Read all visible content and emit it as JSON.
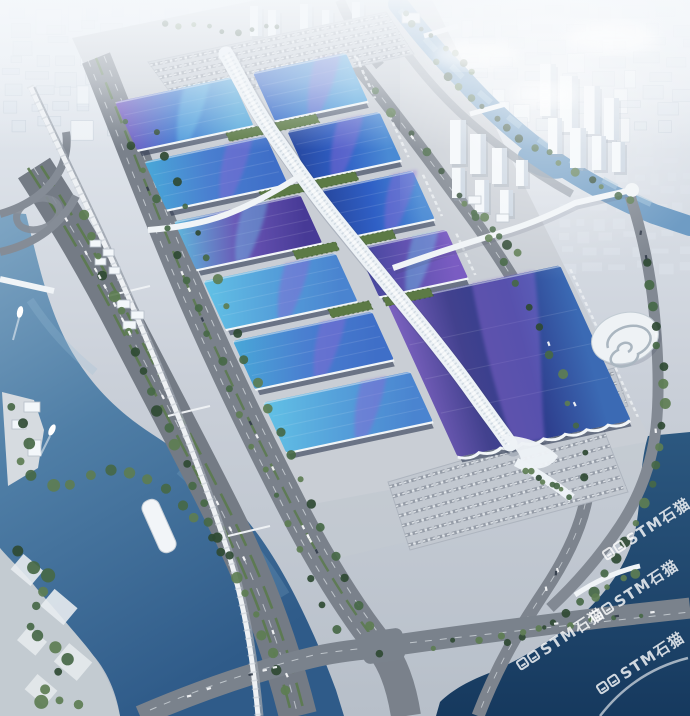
{
  "watermark": {
    "text": "STM石猫",
    "logo": "pixel-cat-squares-icon",
    "color": "#ffffff",
    "opacity": 0.8,
    "rotation_deg": -33,
    "instances": [
      {
        "x": 604,
        "y": 546
      },
      {
        "x": 592,
        "y": 608
      },
      {
        "x": 518,
        "y": 656
      },
      {
        "x": 598,
        "y": 680
      }
    ]
  },
  "palette": {
    "base_top": "#e9eef4",
    "base_mid": "#c9cfd8",
    "base_bottom": "#b7bfc9",
    "haze": "#f5f8fb",
    "city_block": "#dde4ec",
    "city_shadow": "#c2ccd8",
    "building_white": "#f3f7fa",
    "building_side": "#c9d4e0",
    "road": "#767d87",
    "road_light": "#8d949e",
    "lane": "#dde2e7",
    "median_green": "#5f7c4e",
    "tree_dark": "#2f4a33",
    "tree_mid": "#466847",
    "tree_light": "#5d7d52",
    "apron": "#c9ced5",
    "plaza_white": "#e8ecef",
    "water_ne": "#6f9cc4",
    "water_ne_light": "#a8c8de",
    "water_sw_top": "#7fa6c4",
    "water_sw_deep": "#2f5b89",
    "water_se_top": "#2c5880",
    "water_se_deep": "#16395e",
    "spine_white": "#edf2f6",
    "spine_dots": "#b9c6d2",
    "facade_dark": "#2c3750",
    "eave_white": "#f2f6f8",
    "green_roof": "#5c7a45",
    "roof_gradients": {
      "gA": [
        "#7a5cc2",
        "#3f7ad0",
        "#58aadc"
      ],
      "gB": [
        "#2f5fc5",
        "#3f84d2",
        "#55a6de"
      ],
      "gB2": [
        "#27479e",
        "#2f5fc5",
        "#4a8ad4"
      ],
      "gC": [
        "#49a8d8",
        "#4a7fd0",
        "#3f6fc8"
      ],
      "gC2": [
        "#62c2e6",
        "#55a0da",
        "#4a84d0"
      ],
      "gD": [
        "#5fb8dc",
        "#6a55b5",
        "#473a96"
      ],
      "gE": [
        "#43459c",
        "#6152b0",
        "#7a5cc2"
      ],
      "gG": [
        "#7c62c0",
        "#42418e",
        "#2e3f8e",
        "#3b6ab4"
      ]
    },
    "swoosh_purple": "#8a68d4",
    "swoosh_cyan": "#6fd0ee"
  },
  "scene": {
    "halls": [
      {
        "x0": 0,
        "x1": 119,
        "y": 0,
        "h": 52,
        "g": "gA",
        "sw": "c",
        "f": 0.46
      },
      {
        "x0": 141,
        "x1": 236,
        "y": 0,
        "h": 52,
        "g": "gB",
        "sw": "p",
        "f": 0.5
      },
      {
        "x0": 2,
        "x1": 126,
        "y": 64,
        "h": 52,
        "g": "gC",
        "sw": "p",
        "f": 0.55
      },
      {
        "x0": 148,
        "x1": 242,
        "y": 64,
        "h": 52,
        "g": "gB2",
        "sw": "p",
        "f": 0.38
      },
      {
        "x0": 4,
        "x1": 133,
        "y": 128,
        "h": 52,
        "g": "gD",
        "sw": "c",
        "f": 0.42
      },
      {
        "x0": 155,
        "x1": 248,
        "y": 128,
        "h": 52,
        "g": "gB2",
        "sw": "p",
        "f": 0.6
      },
      {
        "x0": 6,
        "x1": 141,
        "y": 192,
        "h": 52,
        "g": "gC2",
        "sw": "p",
        "f": 0.5
      },
      {
        "x0": 163,
        "x1": 254,
        "y": 192,
        "h": 52,
        "g": "gE",
        "sw": "c",
        "f": 0.45
      },
      {
        "x0": 8,
        "x1": 150,
        "y": 256,
        "h": 52,
        "g": "gC",
        "sw": "p",
        "f": 0.52
      },
      {
        "x0": 168,
        "x1": 345,
        "y": 250,
        "h": 165,
        "g": "gG",
        "sw": "p",
        "f": 0.4,
        "w": 64,
        "wavy": true
      },
      {
        "x0": 10,
        "x1": 160,
        "y": 322,
        "h": 54,
        "g": "gC2",
        "sw": "p",
        "f": 0.56
      }
    ],
    "green_roofs": [
      {
        "x": 90,
        "y": 53,
        "w": 40
      },
      {
        "x": 140,
        "y": 53,
        "w": 42
      },
      {
        "x": 96,
        "y": 117,
        "w": 42
      },
      {
        "x": 150,
        "y": 117,
        "w": 44
      },
      {
        "x": 102,
        "y": 181,
        "w": 44
      },
      {
        "x": 158,
        "y": 181,
        "w": 46
      },
      {
        "x": 110,
        "y": 245,
        "w": 42
      },
      {
        "x": 166,
        "y": 245,
        "w": 48
      }
    ],
    "towers": [
      [
        540,
        64,
        16,
        52
      ],
      [
        560,
        76,
        18,
        56
      ],
      [
        584,
        86,
        16,
        48
      ],
      [
        604,
        98,
        15,
        42
      ],
      [
        548,
        118,
        14,
        36
      ],
      [
        570,
        128,
        16,
        40
      ],
      [
        592,
        136,
        14,
        34
      ],
      [
        612,
        142,
        13,
        30
      ],
      [
        450,
        120,
        16,
        44
      ],
      [
        470,
        134,
        16,
        40
      ],
      [
        492,
        148,
        15,
        36
      ],
      [
        452,
        168,
        13,
        30
      ],
      [
        475,
        180,
        14,
        32
      ],
      [
        500,
        190,
        13,
        26
      ],
      [
        516,
        160,
        12,
        26
      ],
      [
        250,
        6,
        12,
        30
      ],
      [
        268,
        10,
        12,
        26
      ],
      [
        300,
        4,
        12,
        34
      ],
      [
        322,
        10,
        11,
        26
      ],
      [
        352,
        2,
        12,
        30
      ]
    ],
    "small_buildings": [
      [
        90,
        240,
        11,
        7
      ],
      [
        103,
        249,
        11,
        7
      ],
      [
        95,
        258,
        11,
        7
      ],
      [
        109,
        267,
        11,
        7
      ],
      [
        117,
        300,
        13,
        8
      ],
      [
        131,
        311,
        13,
        8
      ],
      [
        123,
        321,
        13,
        8
      ],
      [
        24,
        402,
        16,
        10
      ],
      [
        12,
        420,
        14,
        9
      ],
      [
        28,
        440,
        13,
        16
      ],
      [
        468,
        196,
        13,
        8
      ],
      [
        496,
        214,
        13,
        8
      ],
      [
        370,
        24,
        22,
        12
      ],
      [
        402,
        13,
        18,
        10
      ]
    ],
    "parking_lots": [
      {
        "poly": [
          [
            148,
            62
          ],
          [
            386,
            12
          ],
          [
            414,
            54
          ],
          [
            180,
            106
          ]
        ],
        "rows": 7
      },
      {
        "poly": [
          [
            388,
            482
          ],
          [
            600,
            420
          ],
          [
            628,
            492
          ],
          [
            410,
            550
          ]
        ],
        "rows": 7
      },
      {
        "poly": [
          [
            528,
            392
          ],
          [
            614,
            368
          ],
          [
            628,
            406
          ],
          [
            540,
            432
          ]
        ],
        "rows": 4
      }
    ],
    "tree_lines": [
      {
        "pts": [
          [
            84,
            205
          ],
          [
            105,
            275
          ],
          [
            150,
            390
          ],
          [
            205,
            510
          ],
          [
            255,
            615
          ],
          [
            290,
            700
          ]
        ],
        "n": 26,
        "r": 4.5
      },
      {
        "pts": [
          [
            152,
            118
          ],
          [
            205,
            255
          ],
          [
            262,
            395
          ],
          [
            330,
            545
          ],
          [
            385,
            665
          ]
        ],
        "n": 22,
        "r": 4
      },
      {
        "pts": [
          [
            118,
            105
          ],
          [
            168,
            235
          ],
          [
            225,
            375
          ],
          [
            285,
            520
          ],
          [
            340,
            645
          ]
        ],
        "n": 20,
        "r": 3.5
      },
      {
        "pts": [
          [
            428,
            58
          ],
          [
            470,
            98
          ],
          [
            515,
            132
          ],
          [
            558,
            162
          ],
          [
            600,
            184
          ],
          [
            640,
            205
          ]
        ],
        "n": 16,
        "r": 3.5
      },
      {
        "pts": [
          [
            400,
            8
          ],
          [
            428,
            34
          ],
          [
            452,
            52
          ],
          [
            478,
            74
          ]
        ],
        "n": 8,
        "r": 3
      },
      {
        "pts": [
          [
            368,
            80
          ],
          [
            425,
            150
          ],
          [
            478,
            222
          ],
          [
            522,
            292
          ],
          [
            556,
            362
          ],
          [
            580,
            432
          ],
          [
            588,
            492
          ]
        ],
        "n": 18,
        "r": 4
      },
      {
        "pts": [
          [
            648,
            255
          ],
          [
            655,
            310
          ],
          [
            662,
            370
          ],
          [
            664,
            430
          ],
          [
            650,
            495
          ],
          [
            622,
            548
          ],
          [
            588,
            598
          ]
        ],
        "n": 18,
        "r": 4.5
      },
      {
        "pts": [
          [
            500,
            648
          ],
          [
            548,
            622
          ],
          [
            598,
            592
          ],
          [
            645,
            568
          ]
        ],
        "n": 10,
        "r": 4
      },
      {
        "pts": [
          [
            12,
            548
          ],
          [
            52,
            580
          ],
          [
            28,
            628
          ],
          [
            70,
            660
          ],
          [
            36,
            700
          ],
          [
            85,
            706
          ]
        ],
        "n": 14,
        "r": 5.5
      },
      {
        "pts": [
          [
            8,
            396
          ],
          [
            30,
            432
          ],
          [
            20,
            470
          ],
          [
            60,
            488
          ],
          [
            100,
            470
          ],
          [
            140,
            472
          ],
          [
            185,
            505
          ],
          [
            230,
            560
          ]
        ],
        "n": 16,
        "r": 5
      },
      {
        "pts": [
          [
            462,
            200
          ],
          [
            492,
            228
          ],
          [
            520,
            256
          ]
        ],
        "n": 7,
        "r": 4
      },
      {
        "pts": [
          [
            420,
            648
          ],
          [
            500,
            636
          ],
          [
            580,
            622
          ],
          [
            650,
            612
          ]
        ],
        "n": 10,
        "r": 3
      },
      {
        "pts": [
          [
            160,
            22
          ],
          [
            200,
            28
          ],
          [
            240,
            30
          ],
          [
            285,
            28
          ]
        ],
        "n": 9,
        "r": 3
      },
      {
        "pts": [
          [
            522,
            468
          ],
          [
            548,
            482
          ],
          [
            572,
            497
          ]
        ],
        "n": 8,
        "r": 3
      }
    ],
    "cars": [
      {
        "road": "road-hwy",
        "n": 14
      },
      {
        "road": "road-blvd",
        "n": 12
      },
      {
        "road": "road-e1",
        "n": 8
      },
      {
        "road": "road-ringA",
        "n": 6
      },
      {
        "road": "road-ringB",
        "n": 4
      }
    ]
  }
}
